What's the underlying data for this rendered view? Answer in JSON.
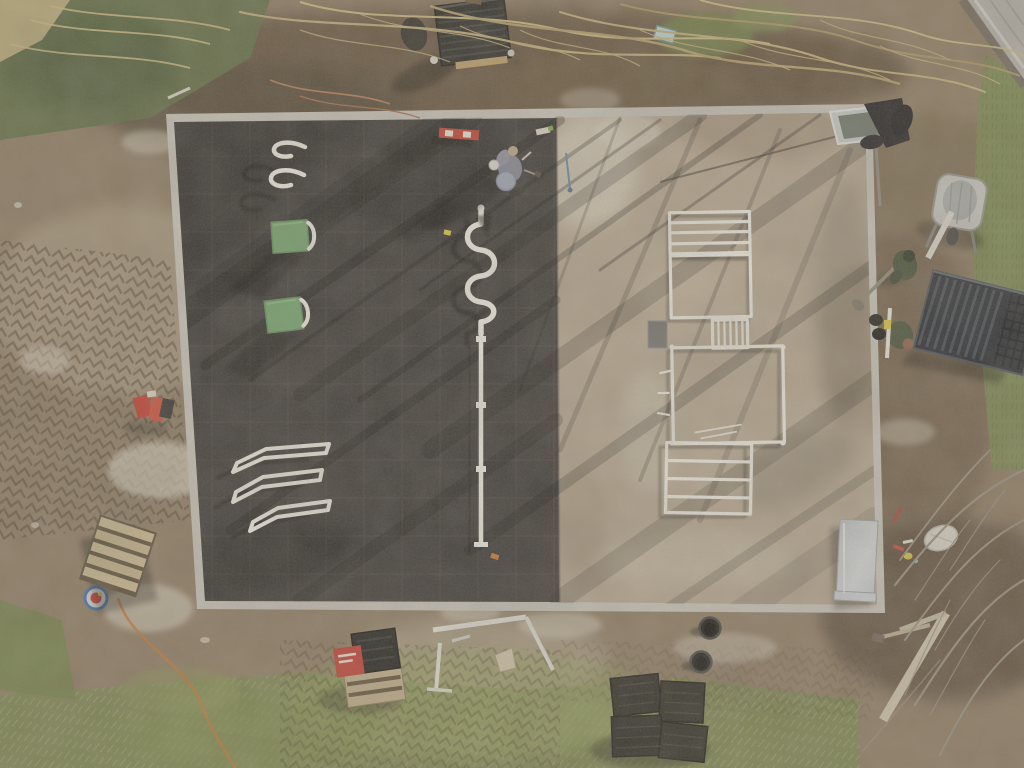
{
  "scene": {
    "type": "aerial-drone-photograph",
    "description": "Top-down drone photo of an outdoor calisthenics workout park under construction: the left half of the rectangular pad is finished with dark rubber safety tiles holding white pull-up hooks, two green step boxes, angled parallel bars, a white snake rail and a disassembled pole; the right half is bare gravel with white steel ladder and frame parts laid flat. A kneeling worker is on the tiles, two workers in green jackets stand at the right edge near a wheelbarrow and a stack of dark grates. Mud with tire tracks, dry branches, grass, pallets, a red-labelled bundle, black pots and rubber tile stacks surround the pad.",
    "objects": [
      {
        "name": "construction-pad",
        "label": "rectangular workout pad"
      },
      {
        "name": "rubber-tile-area",
        "label": "black rubber tile half"
      },
      {
        "name": "gravel-area",
        "label": "gravel base half"
      },
      {
        "name": "pullup-hooks",
        "label": "white wall-bar hooks"
      },
      {
        "name": "step-boxes",
        "label": "green plyo step boxes"
      },
      {
        "name": "parallel-bars",
        "label": "white parallel bars"
      },
      {
        "name": "snake-rail",
        "label": "white serpentine balance rail"
      },
      {
        "name": "ground-pole",
        "label": "disassembled white post"
      },
      {
        "name": "spirit-level",
        "label": "red spirit level"
      },
      {
        "name": "worker-on-pad",
        "label": "kneeling worker"
      },
      {
        "name": "equipment-frames",
        "label": "white ladder frames laid on gravel"
      },
      {
        "name": "metal-sheet",
        "label": "silver sheet-metal panel"
      },
      {
        "name": "solar-lamp-panel",
        "label": "solar lamp panel on pole"
      },
      {
        "name": "storage-crate",
        "label": "black slatted crate"
      },
      {
        "name": "wheelbarrow",
        "label": "grey wheelbarrow"
      },
      {
        "name": "workers-right",
        "label": "two workers in green jackets"
      },
      {
        "name": "grate-stack",
        "label": "stack of dark metal grates"
      },
      {
        "name": "pallet-with-red-bag",
        "label": "pallet with dark tiles and red bundle"
      },
      {
        "name": "wooden-pallet",
        "label": "empty wooden pallet"
      },
      {
        "name": "black-pots",
        "label": "two black ground sleeves"
      },
      {
        "name": "rubber-tile-stacks",
        "label": "stacks of black rubber tiles"
      },
      {
        "name": "orange-cable",
        "label": "orange extension cable"
      },
      {
        "name": "sidewalk",
        "label": "paved path corner"
      },
      {
        "name": "branches",
        "label": "dry brush and bare branches"
      }
    ]
  },
  "palette": {
    "dirt_base": "#8c7a61",
    "dirt_dark": "#5c4b36",
    "dirt_light": "#b4a489",
    "mud_track": "#473a28",
    "grass_green": "#77864c",
    "grass_dark": "#55633a",
    "moss": "#5c6a40",
    "straw": "#b6aa6e",
    "branch_tan": "#c3ae77",
    "branch_gray": "#968e7e",
    "pad_rubber": "#343231",
    "tile_seam": "#47443f",
    "pad_border": "#c9c6bd",
    "gravel": "#b6a791",
    "gravel_light": "#d7cfbf",
    "lime_white": "#d8d0bf",
    "equip_white": "#efede5",
    "box_green": "#6fa36b",
    "level_red": "#c23a2c",
    "sheet_silver": "#c3c9cc",
    "cable_orange": "#c8742c",
    "item_blue": "#bcd8da",
    "jacket_green": "#414c34",
    "grate_dark": "#20242b",
    "person_gray": "#7e8292",
    "bucket_blue": "#9aa3b5",
    "sidewalk_gray": "#b3b2ac",
    "curb_dark": "#6f675a"
  }
}
